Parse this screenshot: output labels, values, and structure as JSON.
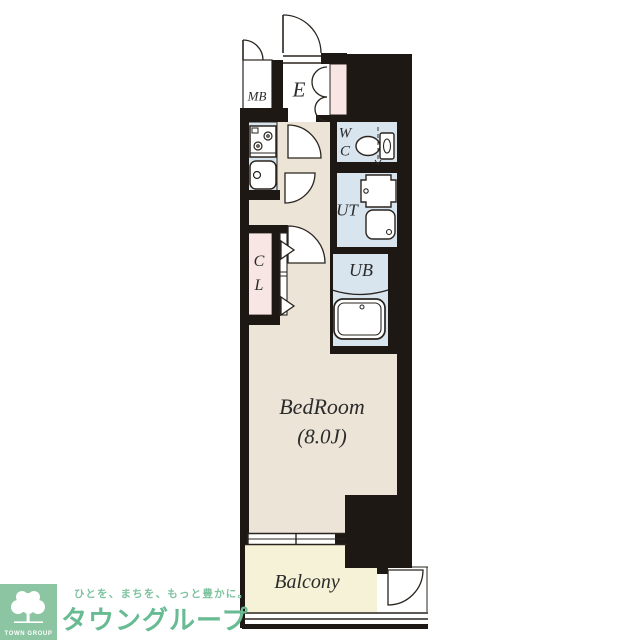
{
  "floorplan": {
    "rooms": {
      "mb": {
        "label": "MB"
      },
      "entrance": {
        "label": "E"
      },
      "wc": {
        "label_line1": "W",
        "label_line2": "C"
      },
      "ut": {
        "label": "UT"
      },
      "ub": {
        "label": "UB"
      },
      "cl": {
        "label_line1": "C",
        "label_line2": "L"
      },
      "bedroom": {
        "label": "BedRoom",
        "size_label": "(8.0J)"
      },
      "balcony": {
        "label": "Balcony"
      }
    },
    "icons": [
      "stove-icon",
      "kitchen-sink-icon",
      "toilet-icon",
      "washing-machine-icon",
      "utility-sink-icon",
      "bathtub-icon",
      "door-swing-icon",
      "double-door-icon",
      "folding-door-icon",
      "sliding-window-icon"
    ]
  },
  "logo": {
    "block_label": "TOWN GROUP",
    "tagline": "ひとを、まちを、もっと豊かに。",
    "brand": "タウングループ"
  },
  "colors": {
    "page": "#ffffff",
    "wall": "#1d1813",
    "floor": "#ece4d7",
    "wet": "#d8e4ee",
    "pink": "#f7e6e3",
    "balcony": "#f5f2d8",
    "fixture": "#ffffff",
    "line": "#2a241e",
    "label": "#2b2b2b",
    "logoGreenBox": "#8cc5a2",
    "logoText": "#68bb93",
    "logoTagline": "#7fc3a0"
  }
}
